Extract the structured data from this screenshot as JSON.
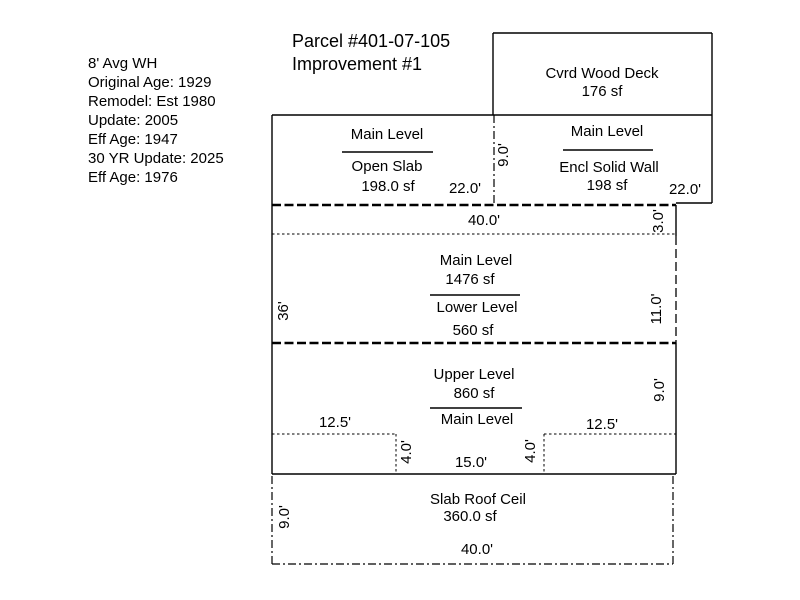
{
  "title": {
    "line1": "Parcel #401-07-105",
    "line2": "Improvement #1"
  },
  "info_block": {
    "lines": [
      "8' Avg WH",
      "Original Age: 1929",
      "Remodel: Est 1980",
      "Update: 2005",
      "Eff Age: 1947",
      "30 YR Update: 2025",
      "Eff Age: 1976"
    ]
  },
  "sketch": {
    "deck": {
      "name": "Cvrd Wood Deck",
      "area": "176 sf"
    },
    "open_slab": {
      "level": "Main Level",
      "wall": "Open Slab",
      "area": "198.0 sf"
    },
    "encl": {
      "level": "Main Level",
      "wall": "Encl Solid Wall",
      "area": "198 sf"
    },
    "main_lower": {
      "upper_label": "Main Level",
      "upper_area": "1476 sf",
      "lower_label": "Lower Level",
      "lower_area": "560 sf"
    },
    "upper_main": {
      "upper_label": "Upper Level",
      "upper_area": "860 sf",
      "lower_label": "Main Level"
    },
    "slab_roof": {
      "name": "Slab Roof Ceil",
      "area": "360.0 sf"
    }
  },
  "dimensions": {
    "top_left_width": "22.0'",
    "top_right_width": "22.0'",
    "porch_depth": "9.0'",
    "strip_width": "40.0'",
    "strip_depth": "3.0'",
    "left_height": "36'",
    "mid_right_depth": "11.0'",
    "upper_right_depth": "9.0'",
    "notch_left_width": "12.5'",
    "notch_right_width": "12.5'",
    "notch_left_depth": "4.0'",
    "notch_right_depth": "4.0'",
    "notch_width": "15.0'",
    "slab_depth": "9.0'",
    "slab_width": "40.0'"
  },
  "colors": {
    "background": "#ffffff",
    "line": "#000000",
    "text": "#000000"
  }
}
